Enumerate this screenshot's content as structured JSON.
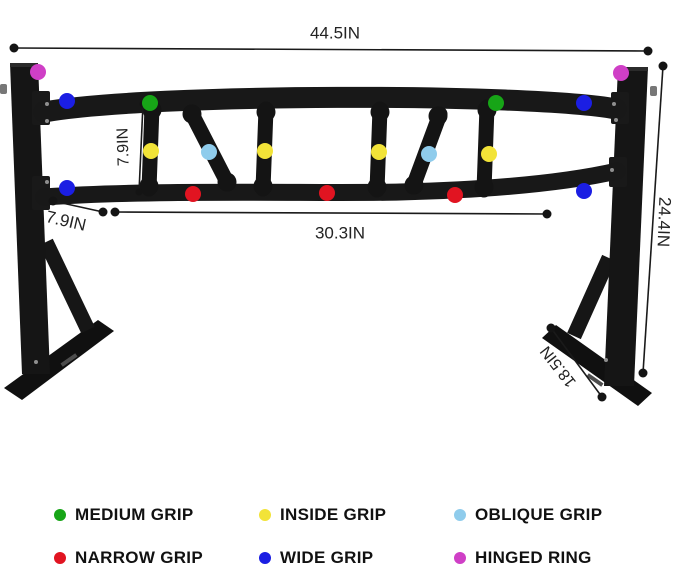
{
  "dimensions": {
    "overall_width": "44.5IN",
    "overall_height": "24.4IN",
    "grip_height": "7.9IN",
    "side_offset": "7.9IN",
    "inner_span": "30.3IN",
    "base_length": "18.5IN"
  },
  "legend": {
    "medium_grip": {
      "label": "MEDIUM GRIP",
      "color": "#17a517"
    },
    "inside_grip": {
      "label": "INSIDE GRIP",
      "color": "#f2e338"
    },
    "oblique_grip": {
      "label": "OBLIQUE GRIP",
      "color": "#8fccec"
    },
    "narrow_grip": {
      "label": "NARROW GRIP",
      "color": "#e11421"
    },
    "wide_grip": {
      "label": "WIDE GRIP",
      "color": "#1b1ee3"
    },
    "hinged_ring": {
      "label": "HINGED RING",
      "color": "#cf3fc6"
    }
  },
  "colors": {
    "steel": "#161616",
    "dimension_line": "#1a1a1a"
  }
}
